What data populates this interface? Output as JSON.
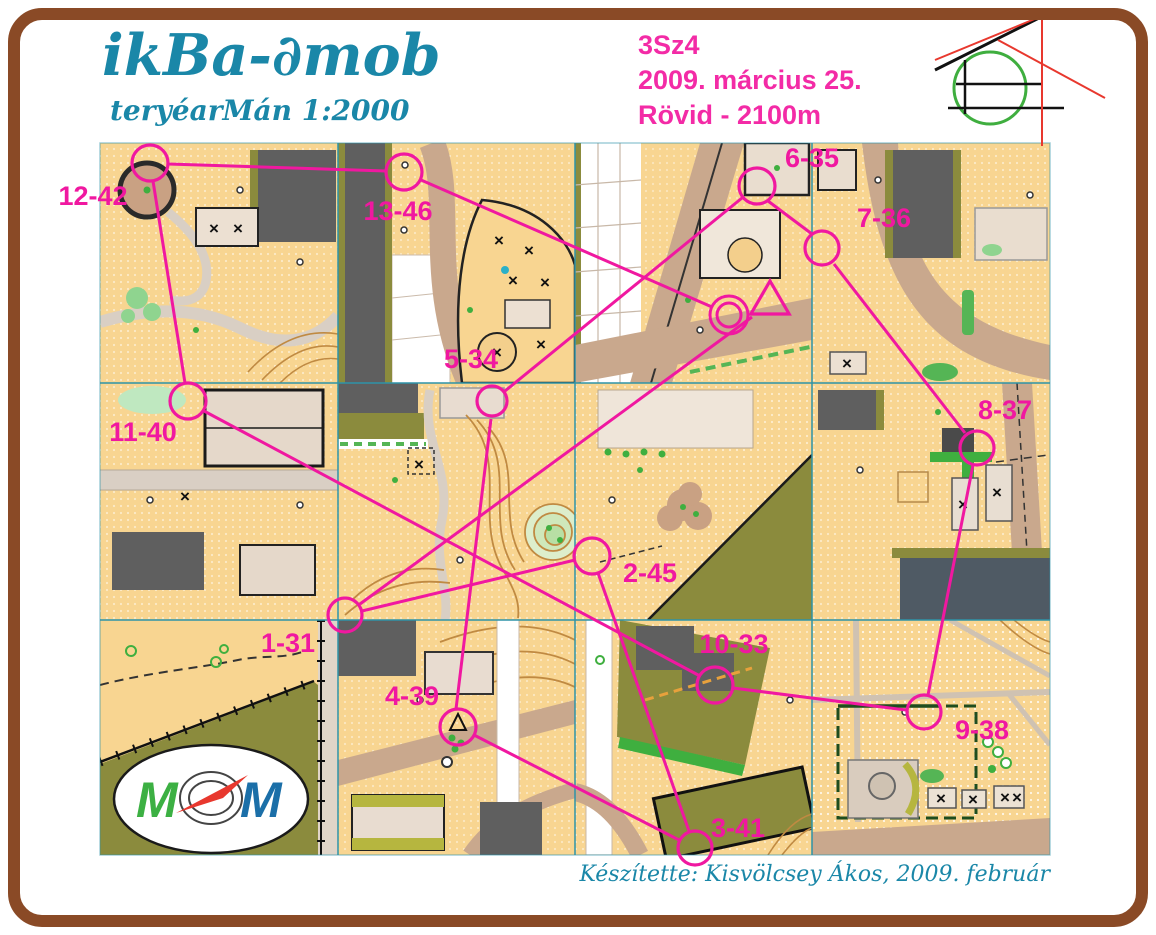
{
  "header": {
    "title": "ikBa-∂mob",
    "subtitle": "teryéarMán 1:2000",
    "event_code": "3Sz4",
    "event_date": "2009. március 25.",
    "event_course": "Rövid - 2100m"
  },
  "footer": {
    "credit": "Készítette: Kisvölcsey Ákos, 2009. február"
  },
  "club_logo": {
    "left": "M",
    "right": "M"
  },
  "colors": {
    "frame_brown": "#8a4a26",
    "title_teal": "#1a87a8",
    "event_magenta": "#f32ba6",
    "course_magenta": "#f018a0",
    "grid_teal": "#2e93a8",
    "map_open_orange": "#f8d591",
    "map_olive_green": "#8b8b3d",
    "map_building_gray": "#5f5f5f",
    "map_road_tan": "#c9a88d",
    "map_canopy_green": "#3faf3f"
  },
  "course": {
    "start": {
      "x": 770,
      "y": 303,
      "size": 22
    },
    "finish": {
      "x": 729,
      "y": 315,
      "r_outer": 19,
      "r_inner": 12
    },
    "controls": [
      {
        "label": "1-31",
        "x": 345,
        "y": 615,
        "r": 17,
        "label_x": 288,
        "label_y": 652
      },
      {
        "label": "2-45",
        "x": 592,
        "y": 556,
        "r": 18,
        "label_x": 650,
        "label_y": 582
      },
      {
        "label": "3-41",
        "x": 695,
        "y": 848,
        "r": 17,
        "label_x": 738,
        "label_y": 837
      },
      {
        "label": "4-39",
        "x": 458,
        "y": 727,
        "r": 18,
        "label_x": 412,
        "label_y": 705
      },
      {
        "label": "5-34",
        "x": 492,
        "y": 401,
        "r": 15,
        "label_x": 471,
        "label_y": 368
      },
      {
        "label": "6-35",
        "x": 757,
        "y": 186,
        "r": 18,
        "label_x": 812,
        "label_y": 167
      },
      {
        "label": "7-36",
        "x": 822,
        "y": 248,
        "r": 17,
        "label_x": 884,
        "label_y": 227
      },
      {
        "label": "8-37",
        "x": 977,
        "y": 448,
        "r": 17,
        "label_x": 1005,
        "label_y": 419
      },
      {
        "label": "9-38",
        "x": 924,
        "y": 712,
        "r": 17,
        "label_x": 982,
        "label_y": 739
      },
      {
        "label": "10-33",
        "x": 715,
        "y": 685,
        "r": 18,
        "label_x": 734,
        "label_y": 653
      },
      {
        "label": "11-40",
        "x": 188,
        "y": 401,
        "r": 18,
        "label_x": 143,
        "label_y": 441
      },
      {
        "label": "12-42",
        "x": 150,
        "y": 163,
        "r": 18,
        "label_x": 93,
        "label_y": 205
      },
      {
        "label": "13-46",
        "x": 404,
        "y": 172,
        "r": 18,
        "label_x": 398,
        "label_y": 220
      }
    ],
    "segments": [
      [
        168,
        164,
        386,
        171
      ],
      [
        421,
        180,
        712,
        307
      ],
      [
        752,
        317,
        360,
        604
      ],
      [
        362,
        611,
        575,
        560
      ],
      [
        598,
        573,
        689,
        831
      ],
      [
        679,
        840,
        474,
        735
      ],
      [
        456,
        709,
        491,
        419
      ],
      [
        505,
        391,
        742,
        198
      ],
      [
        768,
        201,
        812,
        234
      ],
      [
        834,
        264,
        965,
        433
      ],
      [
        973,
        465,
        928,
        695
      ],
      [
        906,
        710,
        733,
        688
      ],
      [
        700,
        676,
        204,
        411
      ],
      [
        185,
        383,
        153,
        181
      ]
    ]
  }
}
